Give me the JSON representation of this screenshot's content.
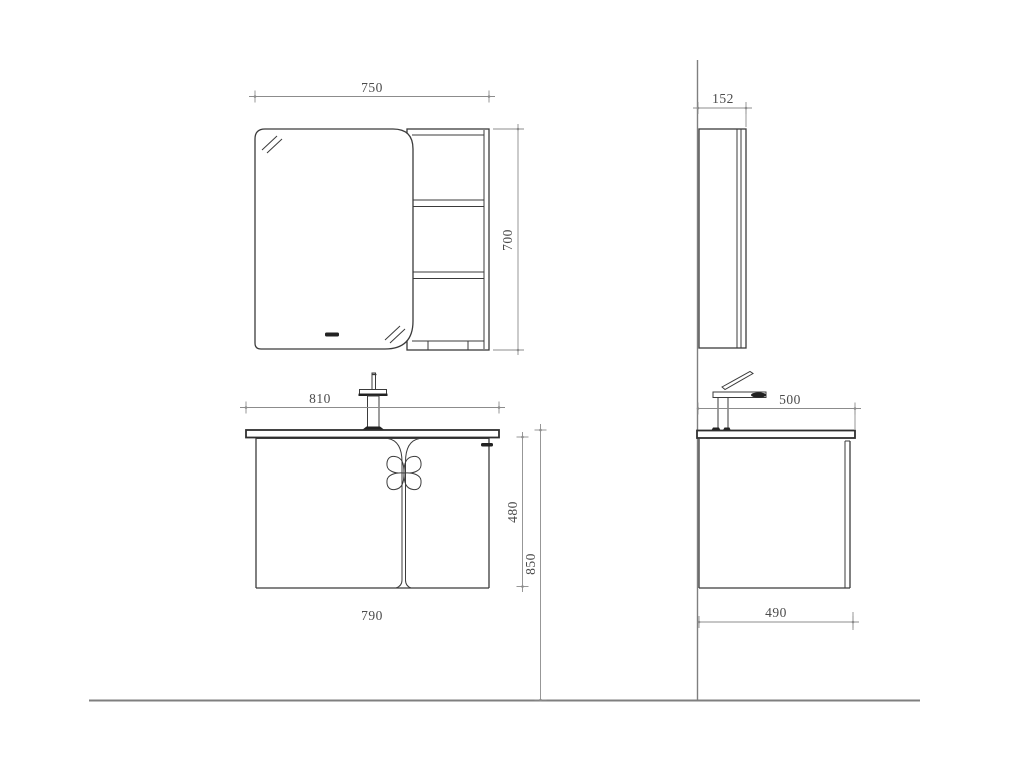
{
  "drawing": {
    "type": "technical-drawing",
    "subject": "Bathroom mirror cabinet and vanity - front and side elevations",
    "units": "mm",
    "colors": {
      "background": "#ffffff",
      "outline": "#3b3b3b",
      "dimension_line": "#8c8c8c",
      "dimension_text": "#4b4b4b",
      "reference_line": "#7f7f7f",
      "accent_fill": "#222222"
    },
    "views": {
      "mirror_front": {
        "width_label": "750",
        "height_label": "700"
      },
      "mirror_side": {
        "depth_label": "152"
      },
      "vanity_front": {
        "counter_width_label": "810",
        "cabinet_height_label": "480",
        "overall_height_label": "850",
        "cabinet_width_label": "790"
      },
      "vanity_side": {
        "counter_depth_label": "500",
        "cabinet_depth_label": "490"
      }
    }
  }
}
